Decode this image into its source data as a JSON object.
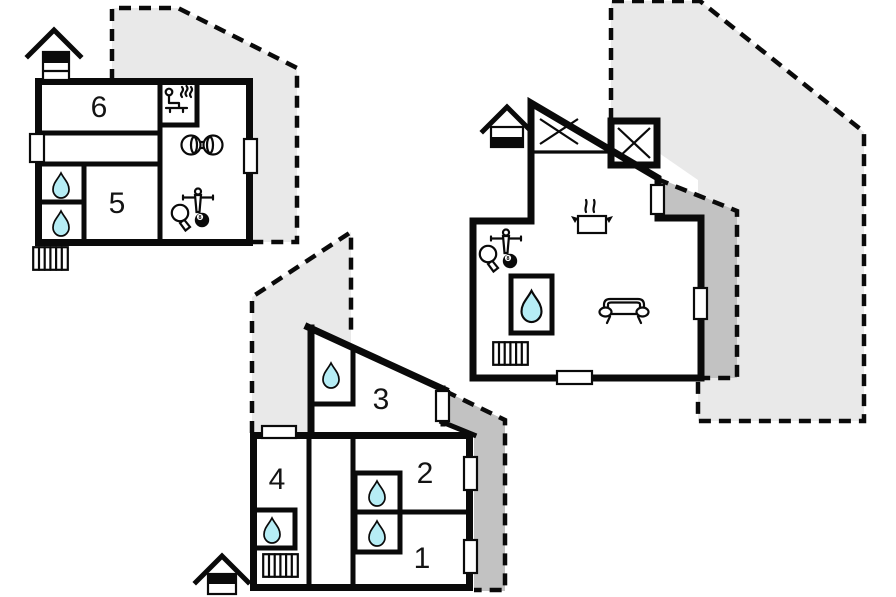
{
  "page": {
    "type": "holiday-house-floor-plan",
    "background": "#ffffff"
  },
  "colors": {
    "wall": "#0a0a0a",
    "terrace_light": "#e9e9e9",
    "terrace_dark": "#c2c2c2",
    "water": "#b6edf5",
    "label": "#141414"
  },
  "plans": [
    {
      "name": "top-floor-plan",
      "rooms": [
        {
          "label": "6"
        },
        {
          "label": "5"
        }
      ],
      "billiard_ball": "8",
      "icons": [
        "entrance-house",
        "sauna",
        "dumbbell",
        "table-tennis-billiards",
        "shower-drop",
        "shower-drop",
        "stairs",
        "terrace-dashed"
      ]
    },
    {
      "name": "main-floor-plan",
      "rooms": [],
      "billiard_ball": "8",
      "icons": [
        "entrance-house",
        "kitchen-pot",
        "table-tennis-billiards",
        "shower-drop",
        "stairs",
        "sofa",
        "terrace-dashed",
        "covered-terrace"
      ]
    },
    {
      "name": "bedroom-floor-plan",
      "rooms": [
        {
          "label": "3"
        },
        {
          "label": "4"
        },
        {
          "label": "2"
        },
        {
          "label": "1"
        }
      ],
      "icons": [
        "entrance-house",
        "shower-drop",
        "shower-drop",
        "shower-drop",
        "stairs",
        "terrace-dashed",
        "covered-terrace"
      ]
    }
  ]
}
